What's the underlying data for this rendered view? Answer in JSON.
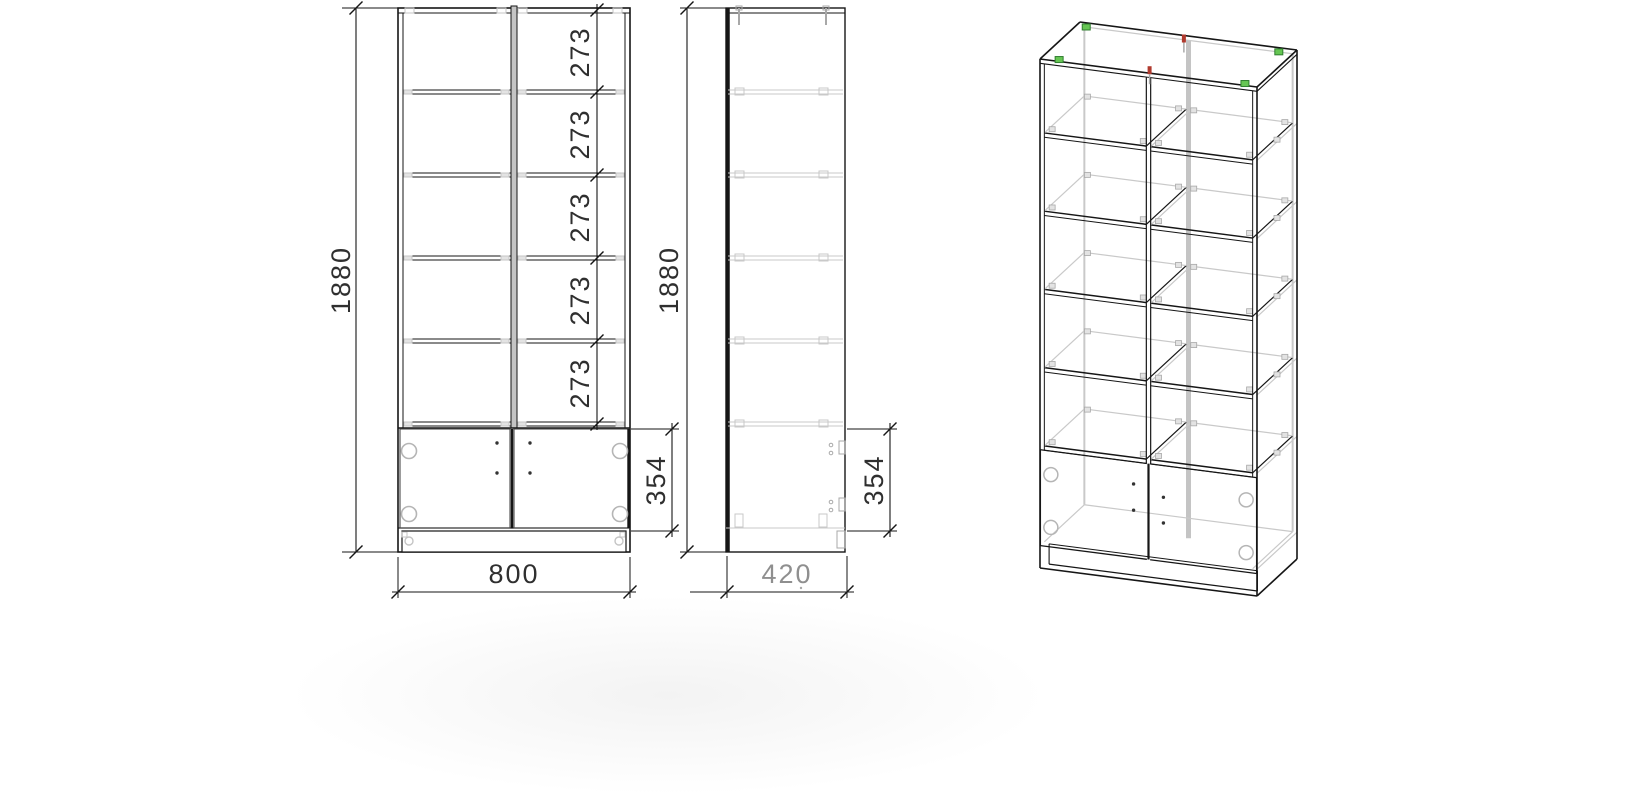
{
  "drawing": {
    "type": "furniture-technical-drawing",
    "views": {
      "front": {
        "height": "1880",
        "width": "800",
        "door_height": "354",
        "shelf_gaps": [
          "273",
          "273",
          "273",
          "273",
          "273"
        ]
      },
      "side": {
        "height": "1880",
        "depth": "420",
        "door_height": "354"
      }
    },
    "cabinet": {
      "height_mm": 1880,
      "width_mm": 800,
      "depth_mm": 420,
      "shelf_spacing_mm": 273,
      "open_shelf_rows": 5,
      "door_section_height_mm": 354,
      "columns": 2
    },
    "colors": {
      "line": "#161616",
      "door_line": "#4a4a4a",
      "light_gray": "#c9c9c9",
      "mid_gray": "#a8a8a8",
      "divider_fill": "#c4c4c4",
      "clip_fill": "#e3e3e3",
      "dim_text": "#2f2f2f",
      "gray_dim_text": "#8f8f8f",
      "fitting_green": "#66c653",
      "fitting_green_border": "#2f7d2f",
      "fitting_red": "#b03a2e",
      "hinge_gray": "#b5b5b5",
      "handle_dot": "#333333"
    }
  }
}
